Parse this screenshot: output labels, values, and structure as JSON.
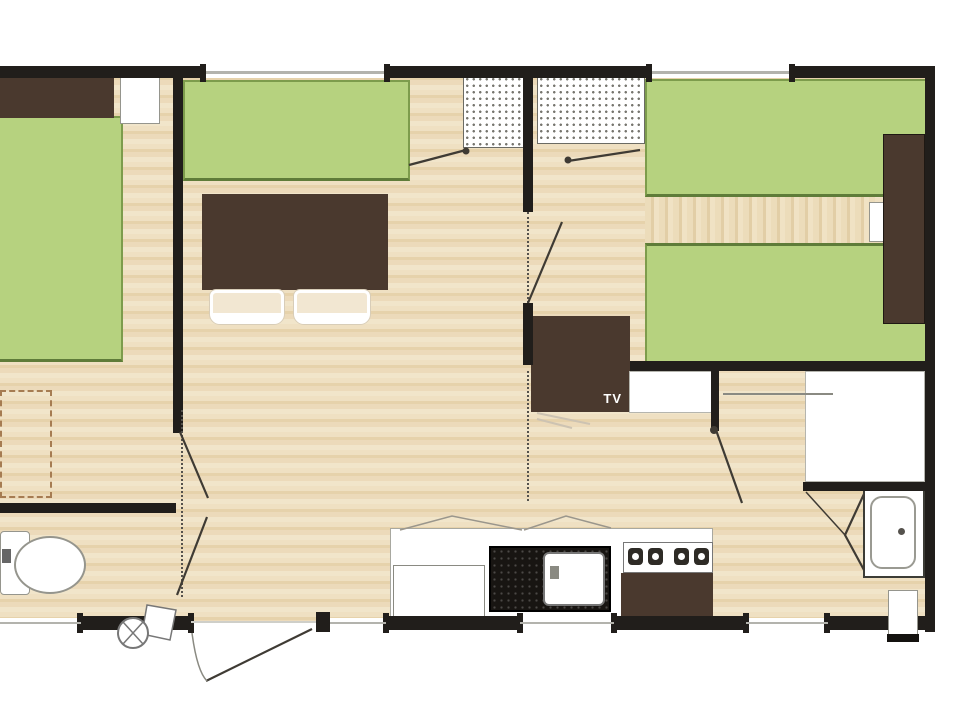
{
  "labels": {
    "tv": "TV"
  },
  "colors": {
    "wall": "#211e1b",
    "floor_base": "#ecdaba",
    "bed_green": "#b6d27f",
    "bed_green_border": "#7d9c4c",
    "furniture_brown": "#4a392e",
    "fixture_white": "#ffffff",
    "window_line": "#b3b3ad",
    "door_line": "#3f3b34"
  },
  "elements": {
    "rooms_visible": [
      "bedroom-left",
      "living-dining",
      "hall-bedroom-right",
      "bedroom-right",
      "wc",
      "kitchen",
      "shower-room"
    ],
    "furniture": [
      "double-bed",
      "headboard",
      "nightstand",
      "sofa",
      "dining-table",
      "chairs",
      "wardrobe-hatched-2x",
      "tv-cabinet",
      "wardrobe-tall",
      "twin-beds",
      "kitchen-counter",
      "fridge",
      "sink",
      "hob-4-burners",
      "kitchen-cabinet",
      "toilet",
      "shower",
      "vanity",
      "entry-step"
    ]
  }
}
